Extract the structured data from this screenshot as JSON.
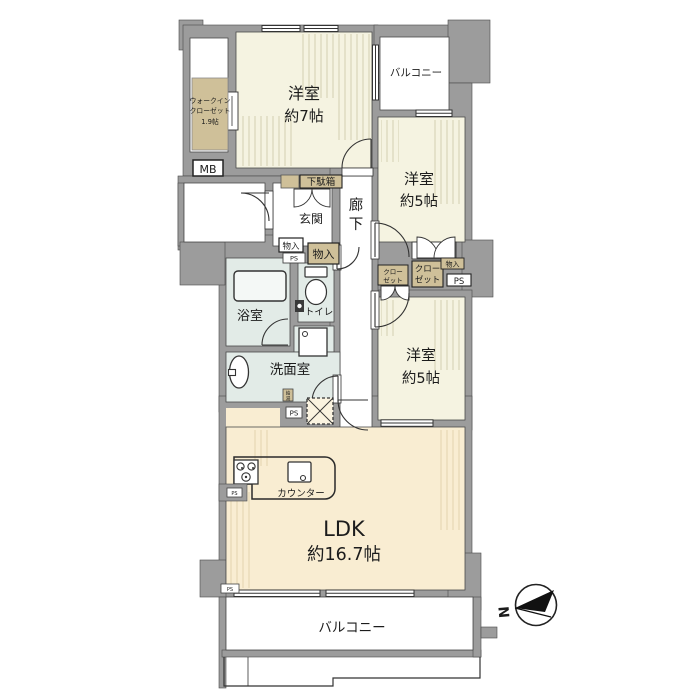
{
  "plan": {
    "rooms": {
      "west7": {
        "label": "洋室",
        "size": "約7帖"
      },
      "west5a": {
        "label": "洋室",
        "size": "約5帖"
      },
      "west5b": {
        "label": "洋室",
        "size": "約5帖"
      },
      "ldk": {
        "label": "LDK",
        "size": "約16.7帖"
      },
      "bath": {
        "label": "浴室"
      },
      "toilet": {
        "label": "トイレ"
      },
      "washroom": {
        "label": "洗面室"
      },
      "entrance": {
        "label": "玄関"
      },
      "hallway": {
        "char1": "廊",
        "char2": "下"
      },
      "balcony_top": {
        "label": "バルコニー"
      },
      "balcony_bottom": {
        "label": "バルコニー"
      },
      "walkin_closet": {
        "line1": "ウォークイン",
        "line2": "クローゼット",
        "line3": "1.9帖"
      }
    },
    "fixtures": {
      "meter_box": "MB",
      "shoe_box": "下駄箱",
      "storage": "物入",
      "pipe_space": "PS",
      "closet_line1": "クロー",
      "closet_line2": "ゼット",
      "counter": "カウンター",
      "water_heater_1": "給",
      "water_heater_2": "湯",
      "north": "N"
    },
    "colors": {
      "wall": "#9c9c9c",
      "bedroom_fill": "#f5f3e1",
      "ldk_fill": "#f9edd2",
      "wet_fill": "#e2ebe7",
      "closet_tan": "#cfc099",
      "line": "#333333"
    }
  }
}
